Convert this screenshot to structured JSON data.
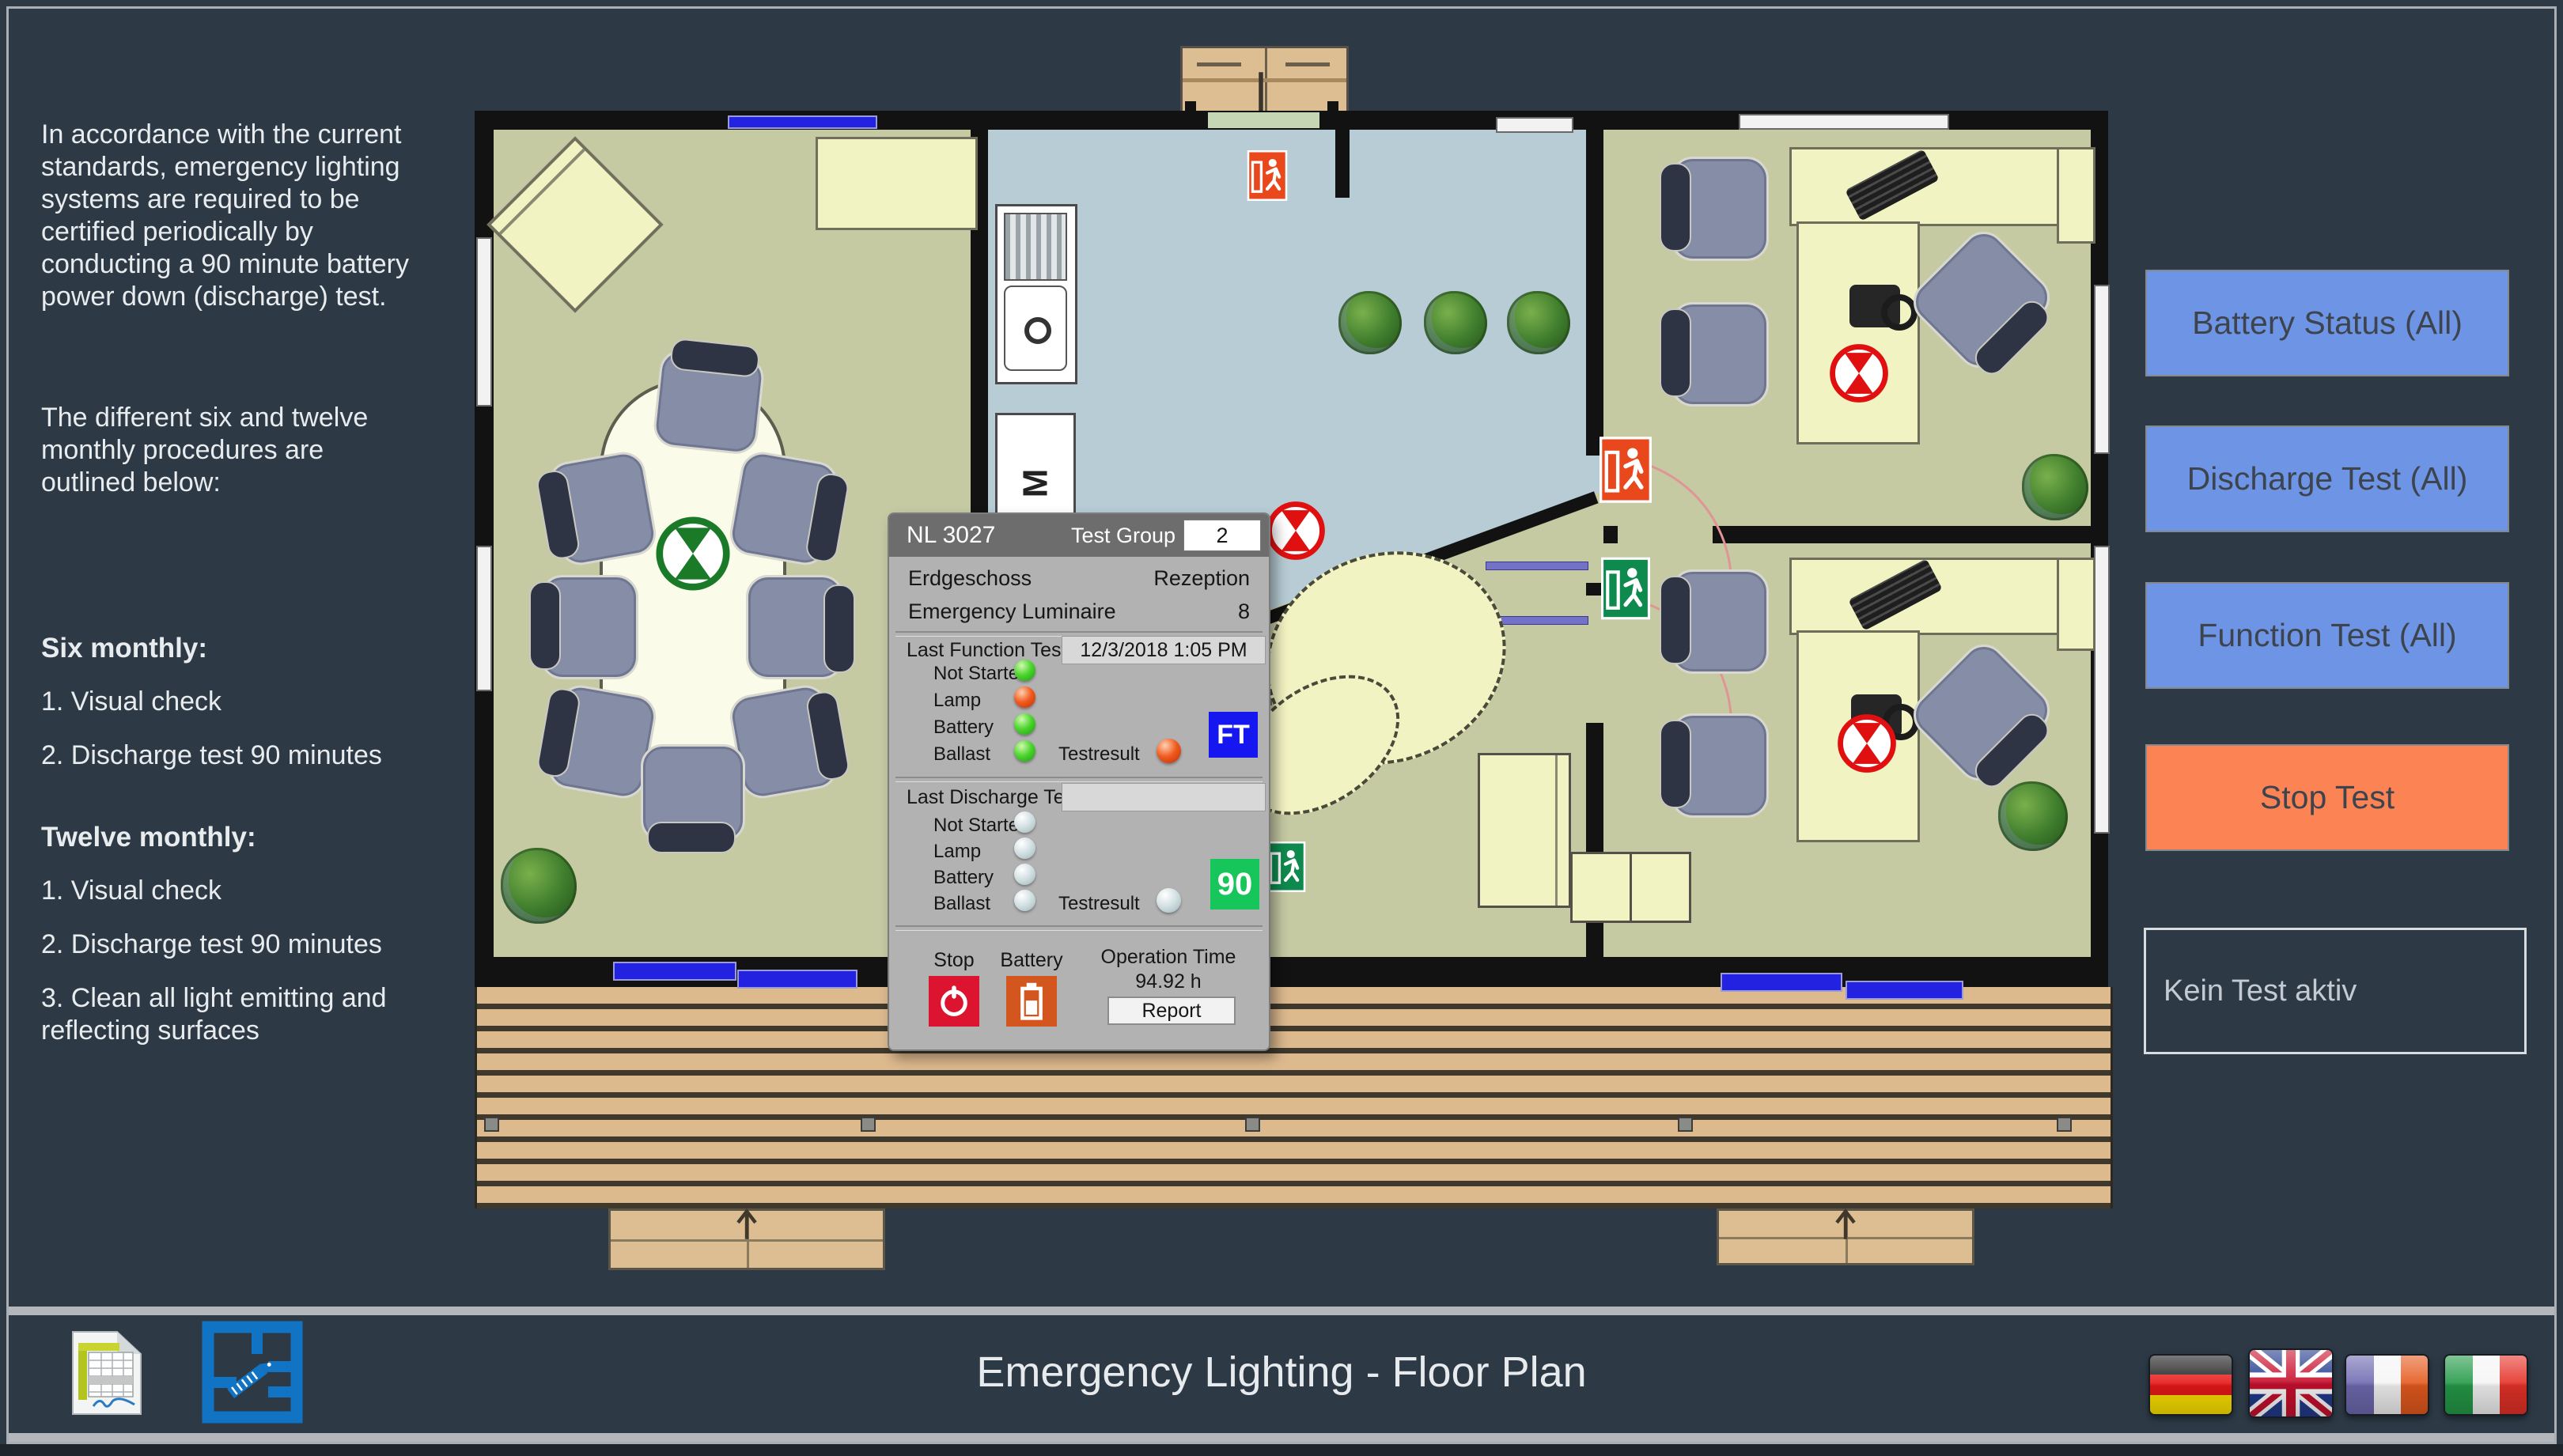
{
  "left_panel": {
    "paragraph1": "In accordance with the current standards, emergency lighting systems are required to be certified periodically by conducting a 90 minute battery power down (discharge) test.",
    "paragraph2": "The different six and twelve monthly procedures are outlined below:",
    "six_monthly_title": "Six monthly:",
    "six_monthly_items": [
      "1. Visual check",
      "2. Discharge test 90 minutes"
    ],
    "twelve_monthly_title": "Twelve monthly:",
    "twelve_monthly_items": [
      "1. Visual check",
      "2. Discharge test 90 minutes",
      "3. Clean all light emitting and reflecting surfaces"
    ]
  },
  "dialog": {
    "title": "NL 3027",
    "test_group_label": "Test Group",
    "test_group_value": "2",
    "floor_name": "Erdgeschoss",
    "room_name": "Rezeption",
    "luminaire_label": "Emergency Luminaire",
    "luminaire_count": "8",
    "function_test": {
      "label": "Last Function Test",
      "date": "12/3/2018 1:05 PM",
      "rows": [
        "Not Started",
        "Lamp",
        "Battery",
        "Ballast"
      ],
      "testresult_label": "Testresult",
      "badge": "FT"
    },
    "discharge_test": {
      "label": "Last Discharge Test",
      "date": "",
      "rows": [
        "Not Started",
        "Lamp",
        "Battery",
        "Ballast"
      ],
      "testresult_label": "Testresult",
      "badge": "90"
    },
    "footer": {
      "stop_label": "Stop",
      "battery_label": "Battery",
      "operation_time_label": "Operation Time",
      "operation_time_value": "94.92 h",
      "report_label": "Report"
    }
  },
  "right_panel": {
    "battery_status_label": "Battery Status (All)",
    "discharge_test_label": "Discharge Test (All)",
    "function_test_label": "Function Test (All)",
    "stop_test_label": "Stop Test",
    "status_message": "Kein Test aktiv"
  },
  "bottom_bar": {
    "title": "Emergency Lighting - Floor Plan"
  },
  "floor_plan": {
    "kitchen_m_label": "M"
  },
  "colors": {
    "background": "#2d3a46",
    "button_blue": "#6e95e5",
    "button_orange": "#fc8354",
    "led_green": "#4ad52c",
    "led_red": "#f05a1e",
    "exit_sign_orange": "#e8481c",
    "exit_sign_green": "#0f8a4e",
    "fault_marker_red": "#e01010",
    "ok_marker_green": "#1a7a28"
  }
}
